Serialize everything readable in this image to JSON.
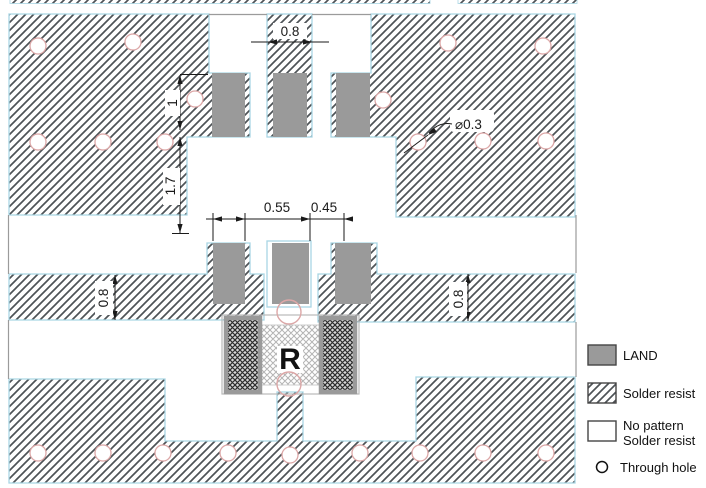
{
  "figure": {
    "component_label": "R"
  },
  "dimensions": {
    "top_pad_width": "0.8",
    "upper_offset": "1",
    "upper_gap": "1.7",
    "center_left": "0.55",
    "center_right": "0.45",
    "band_left": "0.8",
    "band_right": "0.8",
    "hole_diameter": "⌀0.3"
  },
  "legend": {
    "land": "LAND",
    "solder_resist": "Solder resist",
    "no_pattern_line1": "No pattern",
    "no_pattern_line2": "Solder resist",
    "through_hole": "Through hole"
  },
  "colors": {
    "hatch": "#4e5357",
    "region_border": "#a9d6e4",
    "land_gray": "#9a9a9a",
    "hole_outline": "#dca7a7",
    "dimension": "#1a1a1a",
    "boundary_gray": "#9b9b9b"
  }
}
